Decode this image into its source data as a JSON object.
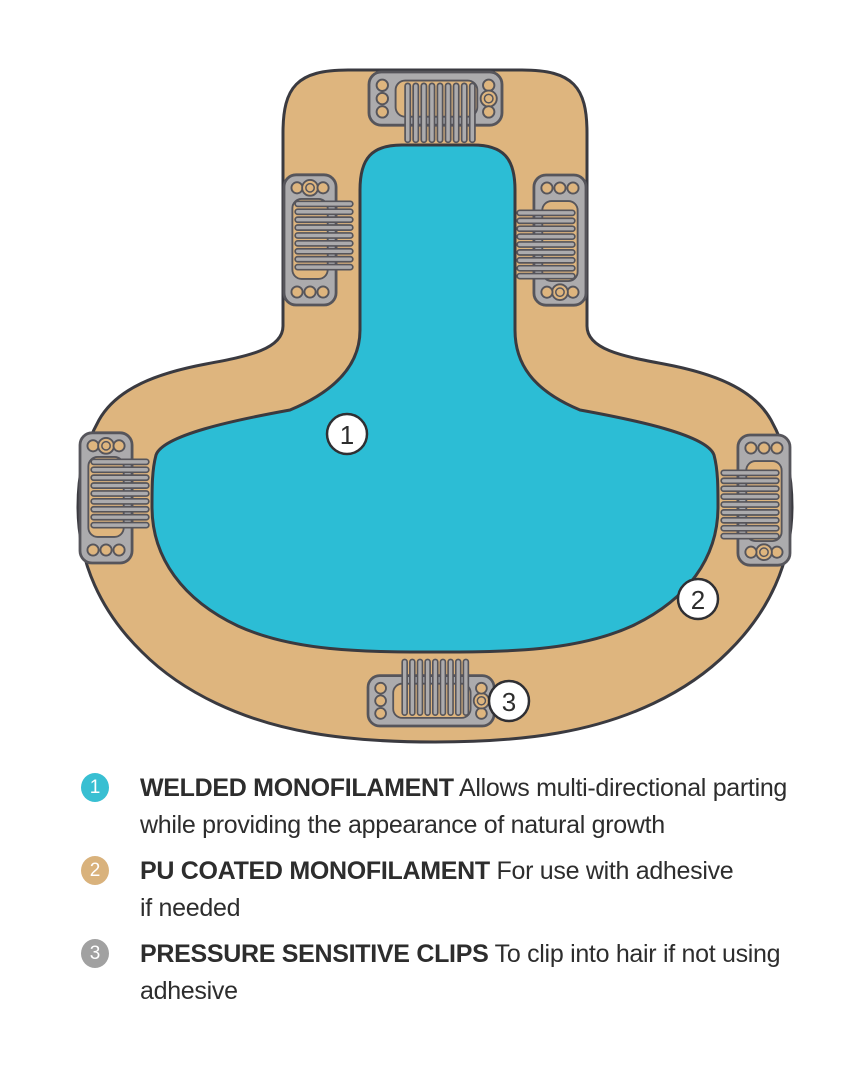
{
  "colors": {
    "background": "#FFFFFF",
    "cap_outer": "#DEB57E",
    "cap_inner": "#2CBDD5",
    "outline": "#3A3A40",
    "clip_body": "#ACABAD",
    "clip_outline": "#56555B",
    "marker_fill": "#FFFFFF",
    "marker_stroke": "#2F2F33",
    "badge_1": "#38BFD2",
    "badge_2": "#D9B27C",
    "badge_3": "#A1A1A1",
    "text": "#2D2D2D"
  },
  "diagram": {
    "description": "Hairpiece base construction top view",
    "markers": [
      {
        "number": "1",
        "x": 347,
        "y": 434
      },
      {
        "number": "2",
        "x": 698,
        "y": 599
      },
      {
        "number": "3",
        "x": 509,
        "y": 701
      }
    ],
    "clip_positions": [
      "top-center",
      "upper-left",
      "upper-right",
      "mid-left",
      "mid-right",
      "bottom-center"
    ]
  },
  "legend": {
    "items": [
      {
        "number": "1",
        "title": "WELDED MONOFILAMENT",
        "description": "Allows multi-directional parting while providing the appearance of natural growth"
      },
      {
        "number": "2",
        "title": "PU COATED MONOFILAMENT",
        "description": "For use with adhesive if needed"
      },
      {
        "number": "3",
        "title": "PRESSURE SENSITIVE CLIPS",
        "description": "To clip into hair if not using adhesive"
      }
    ]
  }
}
